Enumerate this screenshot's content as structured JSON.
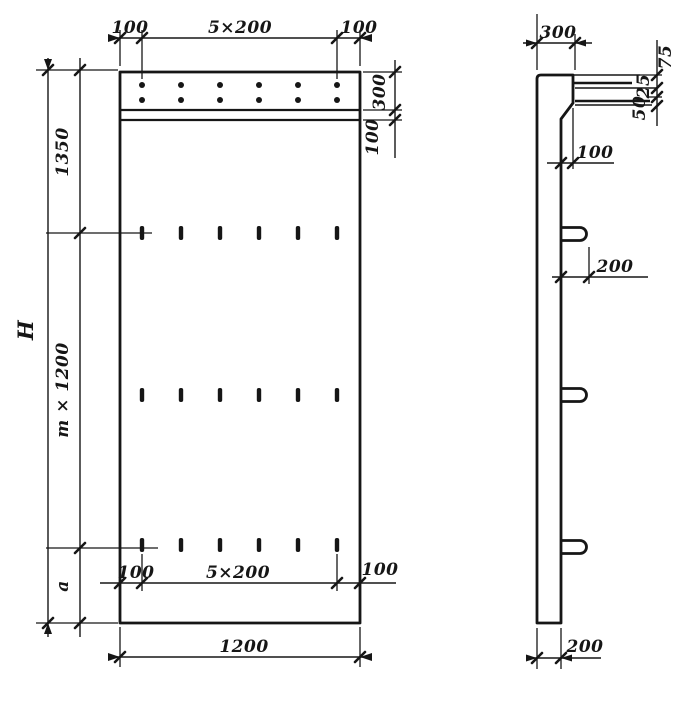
{
  "colors": {
    "ink": "#161616",
    "paper": "#ffffff"
  },
  "front_view": {
    "dim_top_left": "100",
    "dim_top_span": "5×200",
    "dim_top_right": "100",
    "dim_right_band": "300",
    "dim_right_strip": "100",
    "dim_left_top": "1350",
    "dim_left_middle": "m × 1200",
    "dim_left_bottom": "a",
    "dim_height": "H",
    "dim_bottom_left": "100",
    "dim_bottom_span": "5×200",
    "dim_bottom_right": "100",
    "dim_width": "1200",
    "rebar_dot_rows": 2,
    "rebar_dot_cols": 6,
    "slot_rows": 3,
    "slot_cols": 6
  },
  "side_view": {
    "dim_top": "300",
    "dim_chain": [
      "75",
      "25",
      "50"
    ],
    "dim_ledge": "100",
    "dim_hook": "200",
    "dim_thickness": "200",
    "hook_count": 3
  }
}
